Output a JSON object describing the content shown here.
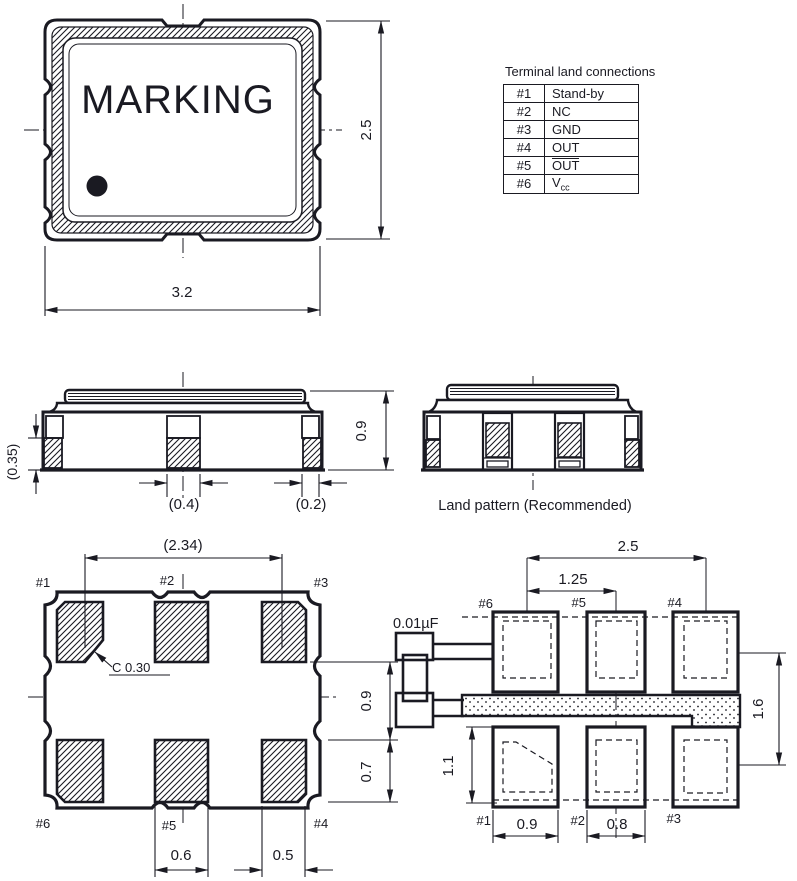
{
  "terminal_table": {
    "title": "Terminal land connections",
    "rows": [
      {
        "pin": "#1",
        "func": "Stand-by"
      },
      {
        "pin": "#2",
        "func": "NC"
      },
      {
        "pin": "#3",
        "func": "GND"
      },
      {
        "pin": "#4",
        "func": "OUT"
      },
      {
        "pin": "#5",
        "func": "OUT"
      },
      {
        "pin": "#6",
        "func_base": "V",
        "func_sub": "cc"
      }
    ]
  },
  "top_view": {
    "marking": "MARKING",
    "width_dim": "3.2",
    "height_dim": "2.5"
  },
  "front_view": {
    "metallization_dim": "(0.35)",
    "center_pad_dim": "(0.4)",
    "edge_pad_dim": "(0.2)",
    "height_dim": "0.9"
  },
  "side_view": {
    "caption": "Land pattern (Recommended)"
  },
  "bottom_view": {
    "pad_span_dim": "(2.34)",
    "chamfer_note": "C 0.30",
    "row_gap_dim": "0.9",
    "pad_height_dim": "0.7",
    "center_pad_width_dim": "0.6",
    "corner_pad_width_dim": "0.5",
    "labels": {
      "p1": "#1",
      "p2": "#2",
      "p3": "#3",
      "p4": "#4",
      "p5": "#5",
      "p6": "#6"
    }
  },
  "land_pattern": {
    "capacitor_label": "0.01µF",
    "outer_pitch_dim": "2.5",
    "inner_pitch_dim": "1.25",
    "row_pitch_dim": "1.6",
    "land_height_dim": "1.1",
    "land_width1_dim": "0.9",
    "land_width2_dim": "0.8",
    "labels": {
      "p1": "#1",
      "p2": "#2",
      "p3": "#3",
      "p4": "#4",
      "p5": "#5",
      "p6": "#6"
    }
  },
  "colors": {
    "line": "#1a1a22",
    "background": "#ffffff"
  }
}
